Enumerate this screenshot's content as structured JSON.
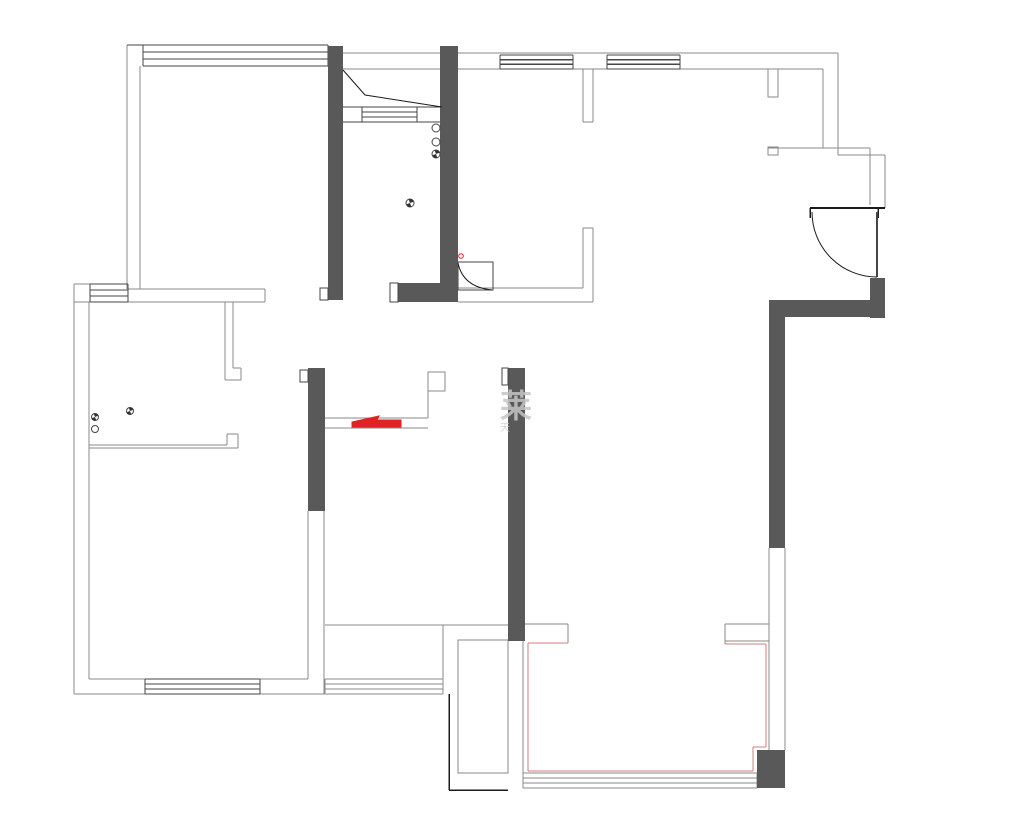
{
  "plan": {
    "type": "residential-floor-plan",
    "canvas": {
      "width": 1026,
      "height": 821,
      "background": "#ffffff"
    },
    "palette": {
      "wall": "#595959",
      "g": "#8a8a8a",
      "d": "#454545",
      "k": "#1b1b1b",
      "r": "#e02222",
      "p": "#cf7f7f",
      "white": "#ffffff"
    },
    "watermark": {
      "line1": "莱",
      "line2": "天"
    },
    "drawing": {
      "fills": [
        [
          328,
          46,
          15,
          254,
          "wall",
          "wall-corridor-left"
        ],
        [
          440,
          46,
          18,
          256,
          "wall",
          "wall-corridor-right"
        ],
        [
          398,
          283,
          60,
          19,
          "wall",
          "wall-corridor-bottom"
        ],
        [
          508,
          368,
          17,
          273,
          "wall",
          "wall-living-divider"
        ],
        [
          308,
          368,
          17,
          143,
          "wall",
          "wall-mid-divider"
        ],
        [
          870,
          278,
          15,
          40,
          "wall",
          "wall-entry-corner"
        ],
        [
          769,
          300,
          116,
          17,
          "wall",
          "wall-entry-top"
        ],
        [
          769,
          317,
          16,
          231,
          "wall",
          "wall-right-side"
        ],
        [
          757,
          750,
          28,
          38,
          "wall",
          "wall-balcony-block"
        ]
      ],
      "white_caps": [
        [
          390,
          283,
          8,
          19
        ],
        [
          320,
          288,
          8,
          12
        ],
        [
          300,
          370,
          8,
          12
        ],
        [
          502,
          368,
          6,
          17
        ]
      ],
      "lines": [
        [
          127,
          45,
          127,
          289,
          "g"
        ],
        [
          140,
          66,
          140,
          289,
          "g"
        ],
        [
          127,
          45,
          143,
          45,
          "d"
        ],
        [
          128,
          289,
          265,
          289,
          "g"
        ],
        [
          74,
          302,
          265,
          302,
          "g"
        ],
        [
          265,
          289,
          265,
          302,
          "g"
        ],
        [
          74,
          284,
          74,
          694,
          "g"
        ],
        [
          74,
          284,
          90,
          284,
          "g"
        ],
        [
          89,
          302,
          89,
          679,
          "g"
        ],
        [
          225,
          302,
          225,
          380,
          "g"
        ],
        [
          233,
          302,
          233,
          368,
          "g"
        ],
        [
          233,
          368,
          241,
          368,
          "g"
        ],
        [
          241,
          368,
          241,
          380,
          "g"
        ],
        [
          225,
          380,
          241,
          380,
          "g"
        ],
        [
          89,
          445,
          227,
          445,
          "g"
        ],
        [
          227,
          434,
          227,
          445,
          "g"
        ],
        [
          227,
          434,
          238,
          434,
          "g"
        ],
        [
          238,
          434,
          238,
          448,
          "g"
        ],
        [
          89,
          448,
          238,
          448,
          "g"
        ],
        [
          89,
          679,
          308,
          679,
          "g"
        ],
        [
          74,
          694,
          325,
          694,
          "g"
        ],
        [
          308,
          511,
          308,
          679,
          "g"
        ],
        [
          324,
          511,
          324,
          694,
          "g"
        ],
        [
          343,
          53,
          838,
          53,
          "g"
        ],
        [
          343,
          69,
          823,
          69,
          "g"
        ],
        [
          343,
          107,
          440,
          107,
          "d"
        ],
        [
          343,
          122,
          440,
          122,
          "d"
        ],
        [
          362,
          112,
          417,
          112,
          "d"
        ],
        [
          362,
          117,
          417,
          117,
          "d"
        ],
        [
          458,
          288,
          583,
          288,
          "g"
        ],
        [
          458,
          302,
          593,
          302,
          "g"
        ],
        [
          583,
          69,
          583,
          122,
          "g"
        ],
        [
          593,
          69,
          593,
          122,
          "g"
        ],
        [
          583,
          122,
          593,
          122,
          "g"
        ],
        [
          583,
          228,
          583,
          288,
          "g"
        ],
        [
          593,
          228,
          593,
          302,
          "g"
        ],
        [
          583,
          228,
          593,
          228,
          "g"
        ],
        [
          823,
          69,
          823,
          148,
          "g"
        ],
        [
          838,
          53,
          838,
          155,
          "g"
        ],
        [
          768,
          148,
          870,
          148,
          "g"
        ],
        [
          838,
          155,
          885,
          155,
          "g"
        ],
        [
          870,
          148,
          870,
          205,
          "g"
        ],
        [
          885,
          155,
          885,
          208,
          "g"
        ],
        [
          810,
          208,
          885,
          208,
          "k",
          2
        ],
        [
          810,
          208,
          810,
          218,
          "k",
          1.5
        ],
        [
          878,
          208,
          878,
          218,
          "k",
          1.5
        ],
        [
          877,
          212,
          877,
          277,
          "d",
          2
        ],
        [
          428,
          390,
          428,
          418,
          "g"
        ],
        [
          325,
          418,
          428,
          418,
          "g"
        ],
        [
          325,
          428,
          428,
          428,
          "g"
        ],
        [
          325,
          625,
          508,
          625,
          "g"
        ],
        [
          443,
          625,
          443,
          679,
          "g"
        ],
        [
          449,
          694,
          449,
          790,
          "k",
          1.5
        ],
        [
          449,
          790,
          508,
          790,
          "k",
          1.5
        ],
        [
          523,
          641,
          523,
          788,
          "g"
        ],
        [
          523,
          624,
          568,
          624,
          "g"
        ],
        [
          568,
          624,
          568,
          643,
          "g"
        ],
        [
          725,
          624,
          769,
          624,
          "g"
        ],
        [
          725,
          624,
          725,
          644,
          "g"
        ],
        [
          725,
          641,
          769,
          641,
          "g"
        ],
        [
          769,
          548,
          769,
          750,
          "g"
        ],
        [
          785,
          548,
          785,
          750,
          "g"
        ],
        [
          528,
          643,
          568,
          643,
          "p",
          1.4
        ],
        [
          528,
          643,
          528,
          771,
          "p",
          1.4
        ],
        [
          528,
          771,
          753,
          771,
          "p",
          1.4
        ],
        [
          725,
          644,
          766,
          644,
          "p",
          1.4
        ],
        [
          766,
          644,
          766,
          747,
          "p",
          1.4
        ],
        [
          753,
          747,
          766,
          747,
          "p",
          1.4
        ],
        [
          753,
          747,
          753,
          771,
          "p",
          1.4
        ]
      ],
      "rect_outlines": [
        [
          362,
          107,
          55,
          15,
          "d",
          "closet-shelf"
        ],
        [
          458,
          262,
          35,
          28,
          "d",
          "bathroom-door-frame"
        ],
        [
          768,
          69,
          10,
          28,
          "g",
          "wall-stub-top"
        ],
        [
          768,
          147,
          10,
          8,
          "g",
          "wall-stub-mid"
        ],
        [
          428,
          372,
          17,
          19,
          "g",
          "cabinet-end"
        ],
        [
          458,
          640,
          50,
          133,
          "g",
          "duct-shaft"
        ]
      ],
      "windows": [
        [
          143,
          45,
          185,
          21,
          "d",
          "window-top-left"
        ],
        [
          90,
          284,
          38,
          18,
          "d",
          "window-left-small"
        ],
        [
          145,
          679,
          115,
          15,
          "d",
          "window-bottom-left"
        ],
        [
          500,
          55,
          73,
          14,
          "d",
          "window-top-mid-1"
        ],
        [
          607,
          55,
          73,
          14,
          "d",
          "window-top-mid-2"
        ],
        [
          523,
          773,
          234,
          15,
          "g",
          "window-balcony"
        ],
        [
          325,
          679,
          118,
          15,
          "g",
          "window-bottom-middle"
        ]
      ],
      "circles": [
        [
          436,
          128,
          4,
          "open"
        ],
        [
          436,
          142,
          4,
          "open"
        ],
        [
          436,
          154,
          4,
          "half"
        ],
        [
          410,
          203,
          4,
          "half"
        ],
        [
          95,
          417,
          3.5,
          "half"
        ],
        [
          130,
          411,
          3.5,
          "half"
        ],
        [
          95,
          429,
          3.5,
          "open"
        ],
        [
          461,
          256,
          2.3,
          "red"
        ]
      ],
      "paths": [
        [
          "M343,70 L365,95 L442,107",
          "k",
          "none",
          1,
          "closet-diagonal"
        ],
        [
          "M458,263 Q463,287 492,290",
          "k",
          "none",
          1,
          "bathroom-door-arc"
        ],
        [
          "M812,212 A65,65 0 0 0 877,277",
          "k",
          "none",
          1,
          "entry-door-arc"
        ],
        [
          "M352,427 L352,422 L379,416 L377,420 L401,420 L401,427 Z",
          "r",
          "r",
          1,
          "red-marker-wedge"
        ]
      ]
    }
  }
}
